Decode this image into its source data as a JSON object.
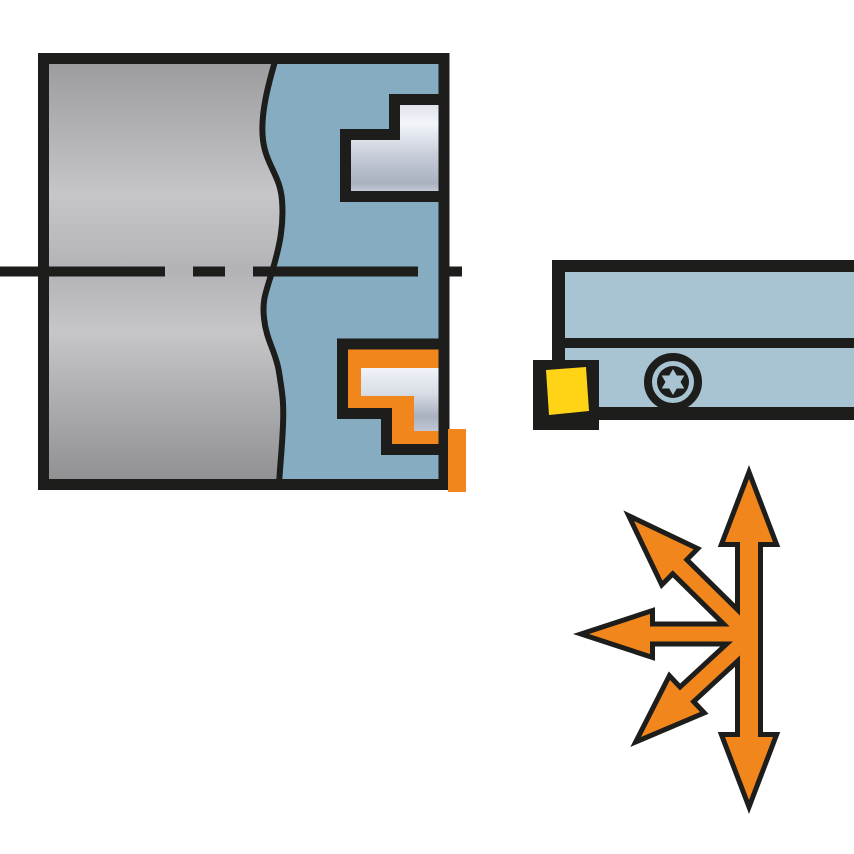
{
  "figure": {
    "type": "technical-illustration",
    "elements": {
      "workpiece": "workpiece-cross-section",
      "tool_body": "tool-body-profile",
      "upper_profile": "machined-step-profile",
      "lower_profile": "tool-path-step-profile",
      "axis": "center-axis-dashed-line",
      "holder": "toolholder-side-view",
      "insert": "cutting-insert",
      "screw": "torx-screw",
      "arrows": "multi-direction-feed-arrows"
    },
    "arrow_directions": [
      "up",
      "down",
      "left",
      "up-left",
      "down-left"
    ]
  },
  "colors": {
    "background": "#ffffff",
    "outline_black": "#1d1d1b",
    "section_blue": "#85acc0",
    "holder_blue": "#a8c4d3",
    "accent_orange": "#f0861c",
    "insert_yellow": "#ffd417",
    "steel_gray_top": "#9b9b9e",
    "steel_gray_light": "#c6c6c8",
    "steel_gray_mid": "#b3b3b6",
    "steel_gray_bottom": "#8f8f92",
    "silver_light": "#f2f5fa",
    "silver_mid": "#c3c9d5",
    "silver_dark": "#a9b1c0",
    "silver_end": "#d9dde5"
  }
}
